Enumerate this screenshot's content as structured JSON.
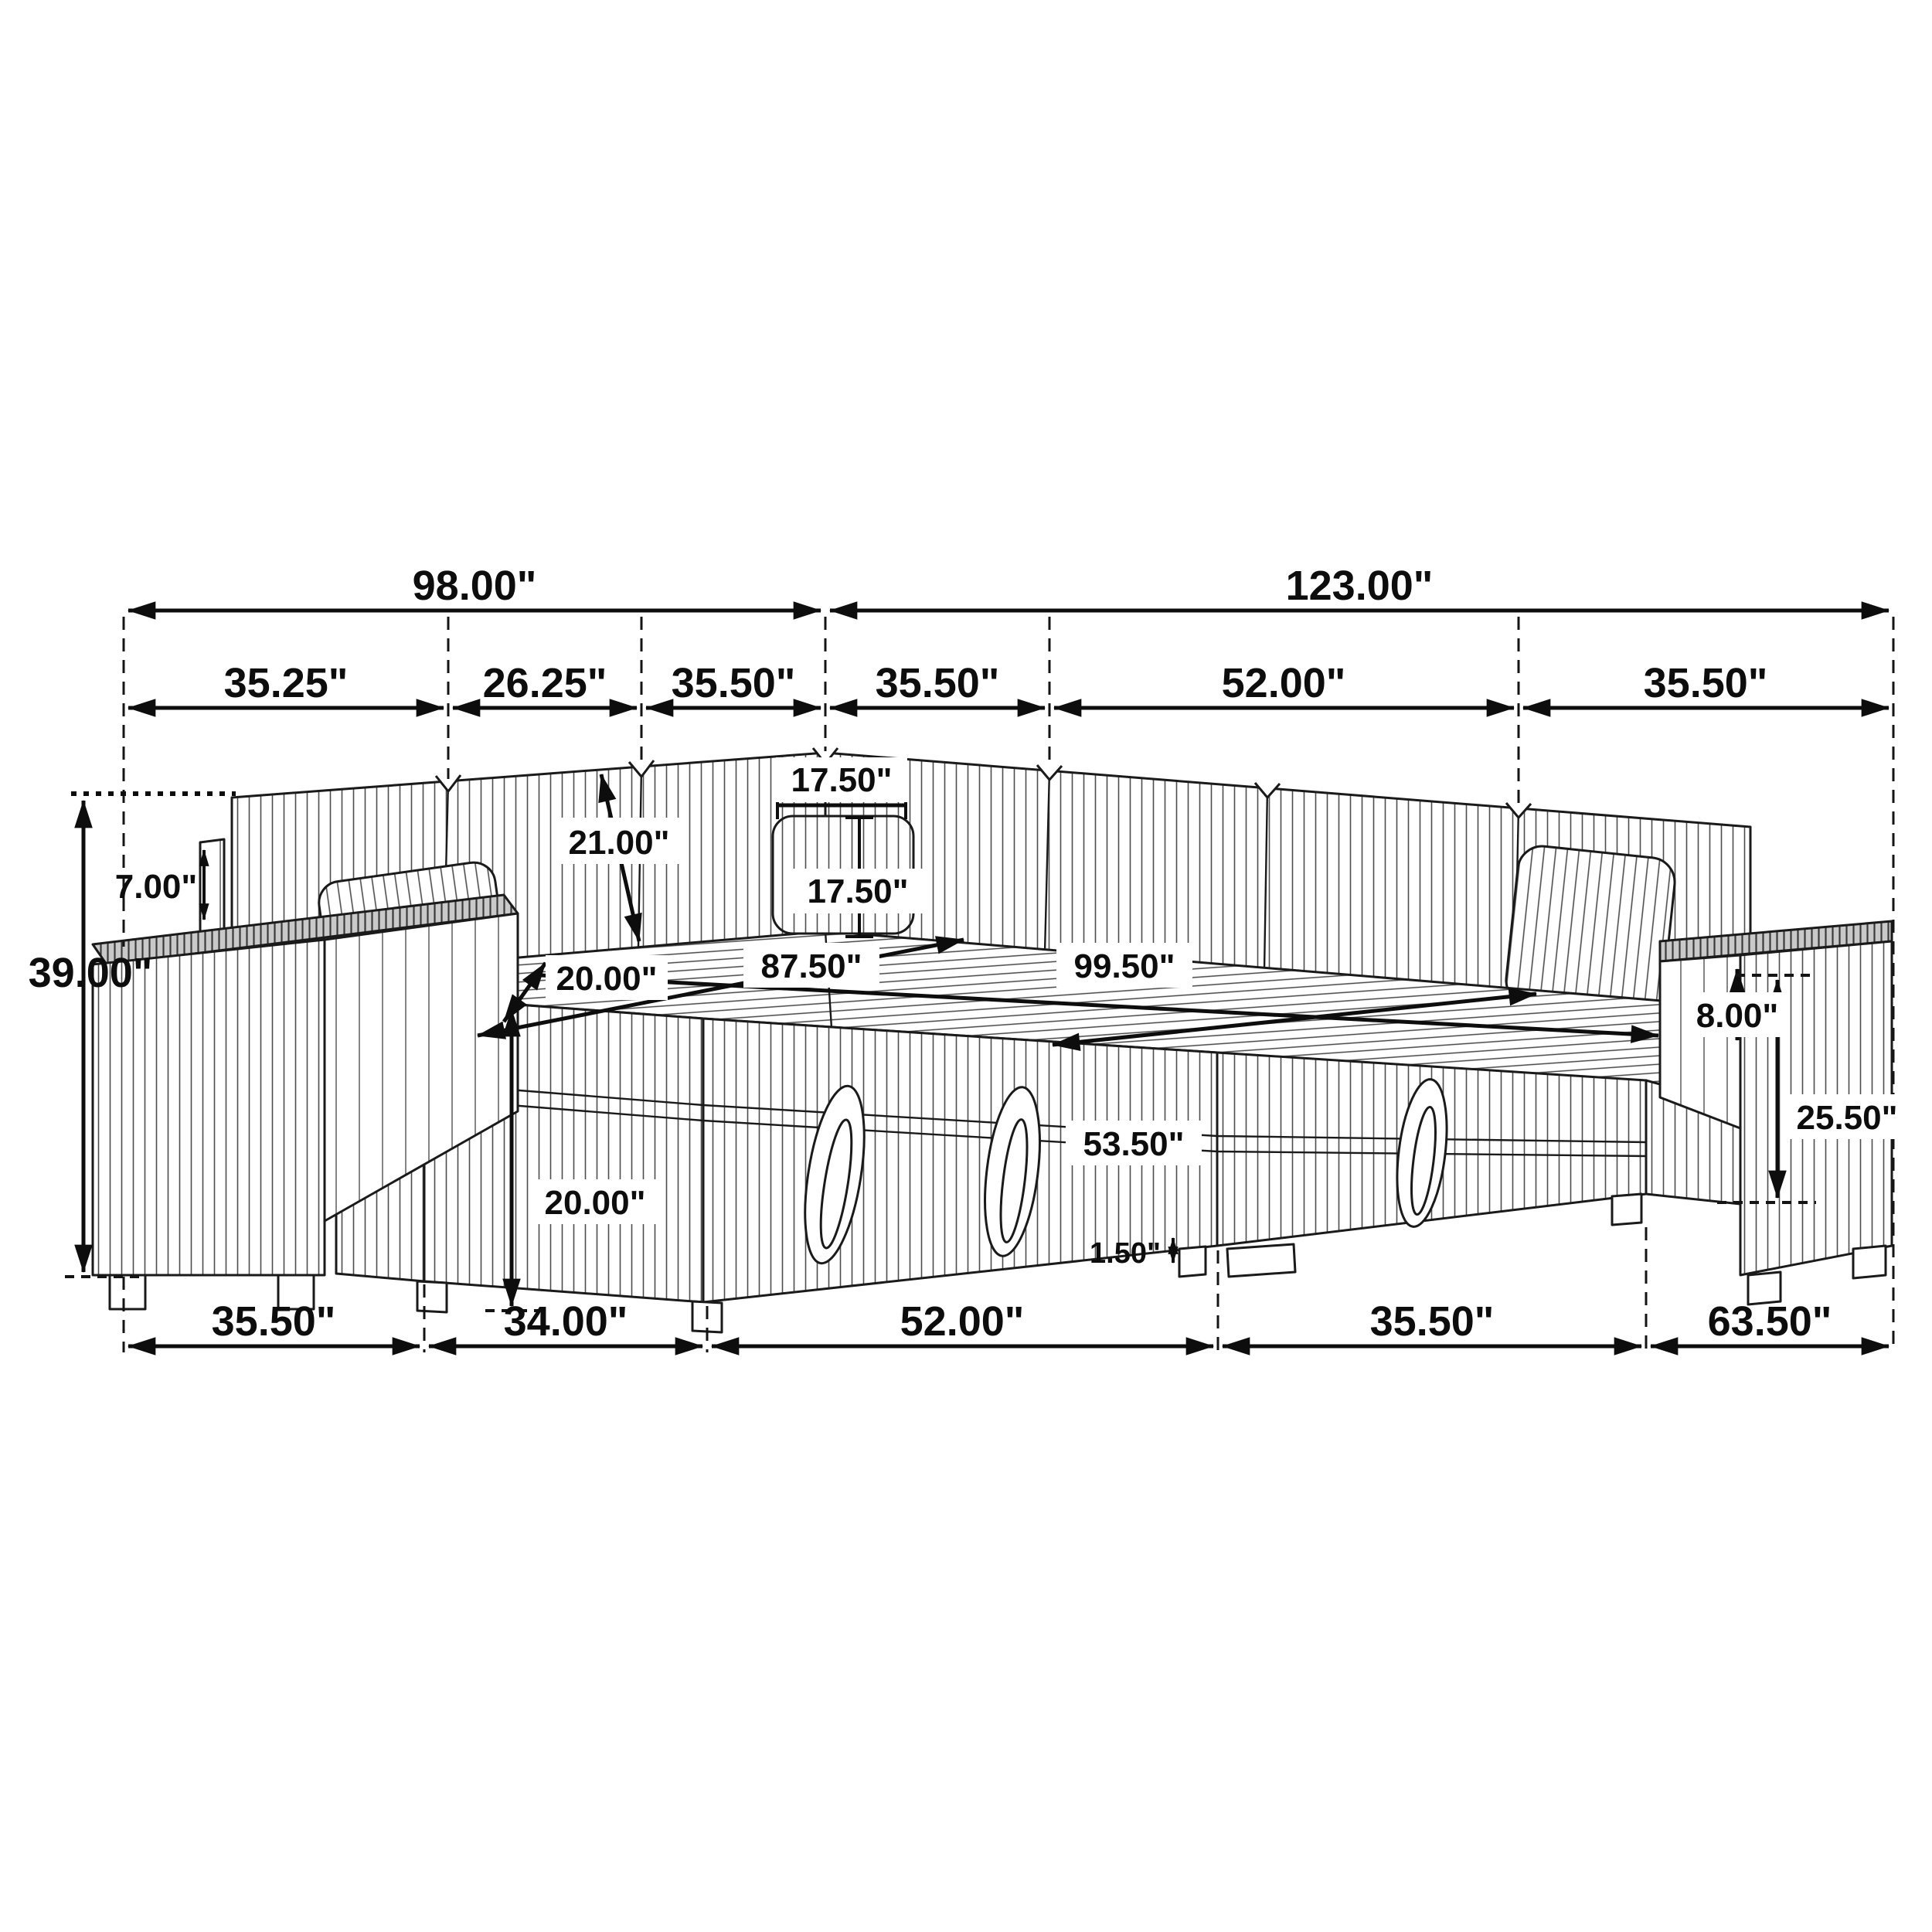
{
  "diagram": {
    "kind": "furniture-dimension-line-drawing",
    "subject": "u-shaped-sleeper-sectional-with-storage",
    "unit": "inches",
    "line_color": "#1a1a1a",
    "dim_color": "#0d0d0d",
    "background": "#ffffff",
    "arm_top_shade": "#c9c9c9"
  },
  "dims": {
    "row_top": [
      {
        "name": "overall-width-left-wing",
        "label": "98.00\""
      },
      {
        "name": "overall-width-right-wing",
        "label": "123.00\""
      }
    ],
    "row_upper": [
      {
        "name": "left-arm-span",
        "label": "35.25\""
      },
      {
        "name": "left-back-cushion-span",
        "label": "26.25\""
      },
      {
        "name": "corner-cushion-span-left",
        "label": "35.50\""
      },
      {
        "name": "corner-cushion-span-right",
        "label": "35.50\""
      },
      {
        "name": "right-back-cushion-span",
        "label": "52.00\""
      },
      {
        "name": "right-arm-span",
        "label": "35.50\""
      }
    ],
    "row_bottom": [
      {
        "name": "left-arm-depth",
        "label": "35.50\""
      },
      {
        "name": "left-chaise-span",
        "label": "34.00\""
      },
      {
        "name": "front-bed-span",
        "label": "52.00\""
      },
      {
        "name": "right-seat-span",
        "label": "35.50\""
      },
      {
        "name": "right-arm-depth",
        "label": "63.50\""
      }
    ],
    "body": {
      "total_height": "39.00\"",
      "arm_post_height": "7.00\"",
      "back_cushion_height": "21.00\"",
      "pillow_width": "17.50\"",
      "pillow_height": "17.50\"",
      "seat_depth": "20.00\"",
      "seat_height": "20.00\"",
      "bed_width": "87.50\"",
      "bed_length": "99.50\"",
      "bed_depth": "53.50\"",
      "arm_above_seat": "8.00\"",
      "arm_total_height": "25.50\"",
      "foot_clearance": "1.50\""
    }
  }
}
